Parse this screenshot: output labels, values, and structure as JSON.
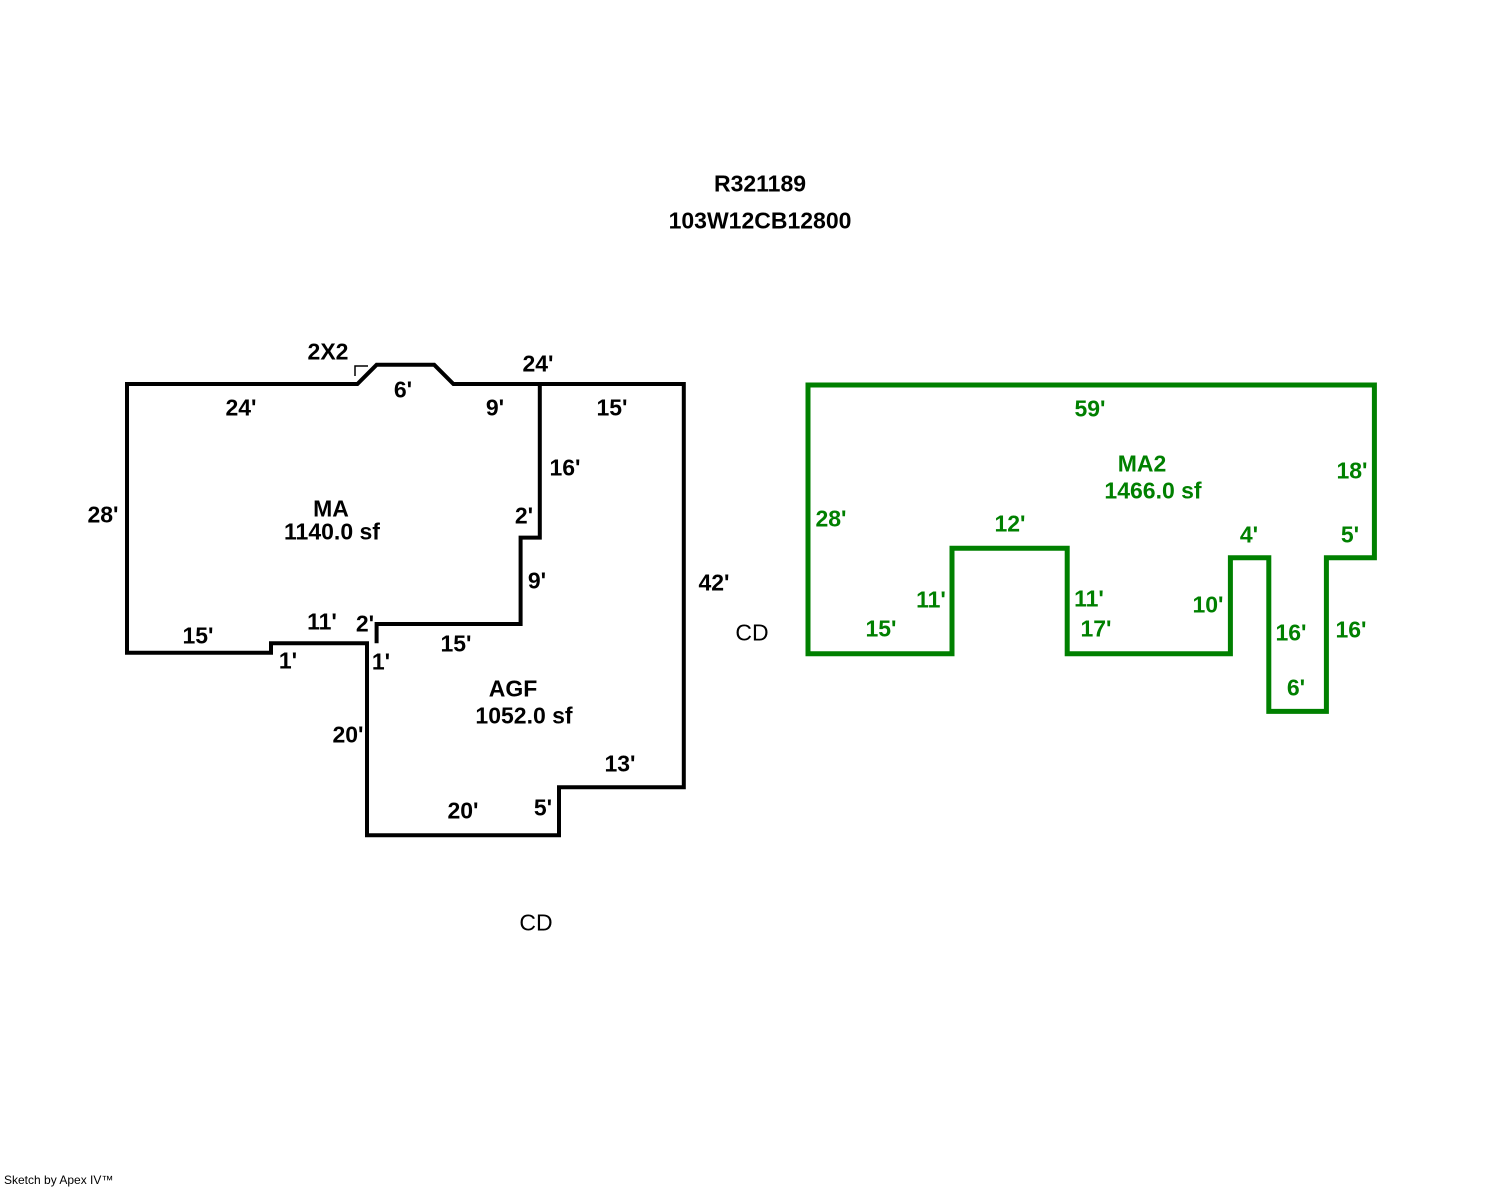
{
  "header": {
    "line1": "R321189",
    "line2": "103W12CB12800"
  },
  "footer": {
    "credit": "Sketch by Apex IV™"
  },
  "colors": {
    "black": "#000000",
    "green": "#008000",
    "background": "#ffffff"
  },
  "sketch": {
    "scale_px_per_ft": 9.6,
    "figures": [
      {
        "name": "main-building",
        "color": "black",
        "stroke_width": 4,
        "origin_px": [
          127,
          384
        ],
        "paths": [
          {
            "name": "outer-perimeter",
            "closed": true,
            "points_ft": [
              [
                0,
                0
              ],
              [
                24,
                0
              ],
              [
                26,
                -2
              ],
              [
                32,
                -2
              ],
              [
                34,
                0
              ],
              [
                58,
                0
              ],
              [
                58,
                42
              ],
              [
                45,
                42
              ],
              [
                45,
                47
              ],
              [
                25,
                47
              ],
              [
                25,
                27
              ],
              [
                15,
                27
              ],
              [
                15,
                28
              ],
              [
                0,
                28
              ]
            ]
          },
          {
            "name": "ma-agf-divider",
            "closed": false,
            "points_ft": [
              [
                43,
                0
              ],
              [
                43,
                16
              ],
              [
                41,
                16
              ],
              [
                41,
                25
              ],
              [
                26,
                25
              ],
              [
                26,
                27
              ]
            ]
          }
        ],
        "corner_marks": [
          {
            "name": "bay-corner-mark",
            "points_px": [
              [
                355,
                376
              ],
              [
                355,
                366
              ],
              [
                368,
                366
              ]
            ]
          }
        ],
        "area_labels": [
          {
            "text": "MA",
            "x": 331,
            "y": 509
          },
          {
            "text": "1140.0 sf",
            "x": 332,
            "y": 532
          },
          {
            "text": "AGF",
            "x": 513,
            "y": 689
          },
          {
            "text": "1052.0 sf",
            "x": 524,
            "y": 716
          }
        ],
        "dim_labels": [
          {
            "text": "2X2",
            "x": 328,
            "y": 352
          },
          {
            "text": "24'",
            "x": 241,
            "y": 408
          },
          {
            "text": "6'",
            "x": 403,
            "y": 390
          },
          {
            "text": "9'",
            "x": 495,
            "y": 408
          },
          {
            "text": "24'",
            "x": 538,
            "y": 364
          },
          {
            "text": "15'",
            "x": 612,
            "y": 408
          },
          {
            "text": "16'",
            "x": 565,
            "y": 468
          },
          {
            "text": "28'",
            "x": 103,
            "y": 515
          },
          {
            "text": "2'",
            "x": 524,
            "y": 516
          },
          {
            "text": "9'",
            "x": 537,
            "y": 581
          },
          {
            "text": "42'",
            "x": 714,
            "y": 583
          },
          {
            "text": "15'",
            "x": 198,
            "y": 636
          },
          {
            "text": "11'",
            "x": 322,
            "y": 622
          },
          {
            "text": "2'",
            "x": 365,
            "y": 624
          },
          {
            "text": "1'",
            "x": 288,
            "y": 661
          },
          {
            "text": "1'",
            "x": 381,
            "y": 662
          },
          {
            "text": "15'",
            "x": 456,
            "y": 644
          },
          {
            "text": "20'",
            "x": 348,
            "y": 735
          },
          {
            "text": "13'",
            "x": 620,
            "y": 764
          },
          {
            "text": "20'",
            "x": 463,
            "y": 811
          },
          {
            "text": "5'",
            "x": 543,
            "y": 808
          }
        ],
        "adjacent_labels": [
          {
            "text": "CD",
            "x": 752,
            "y": 633
          },
          {
            "text": "CD",
            "x": 536,
            "y": 923
          }
        ]
      },
      {
        "name": "ma2-building",
        "color": "green",
        "stroke_width": 5,
        "origin_px": [
          808,
          385
        ],
        "paths": [
          {
            "name": "ma2-perimeter",
            "closed": true,
            "points_ft": [
              [
                0,
                0
              ],
              [
                59,
                0
              ],
              [
                59,
                18
              ],
              [
                54,
                18
              ],
              [
                54,
                34
              ],
              [
                48,
                34
              ],
              [
                48,
                18
              ],
              [
                44,
                18
              ],
              [
                44,
                28
              ],
              [
                27,
                28
              ],
              [
                27,
                17
              ],
              [
                15,
                17
              ],
              [
                15,
                28
              ],
              [
                0,
                28
              ]
            ]
          }
        ],
        "corner_marks": [],
        "area_labels": [
          {
            "text": "MA2",
            "x": 1142,
            "y": 464
          },
          {
            "text": "1466.0 sf",
            "x": 1153,
            "y": 491
          }
        ],
        "dim_labels": [
          {
            "text": "59'",
            "x": 1090,
            "y": 409
          },
          {
            "text": "28'",
            "x": 831,
            "y": 519
          },
          {
            "text": "18'",
            "x": 1352,
            "y": 471
          },
          {
            "text": "12'",
            "x": 1010,
            "y": 524
          },
          {
            "text": "4'",
            "x": 1249,
            "y": 535
          },
          {
            "text": "5'",
            "x": 1350,
            "y": 535
          },
          {
            "text": "11'",
            "x": 931,
            "y": 600
          },
          {
            "text": "11'",
            "x": 1089,
            "y": 599
          },
          {
            "text": "10'",
            "x": 1208,
            "y": 605
          },
          {
            "text": "15'",
            "x": 881,
            "y": 629
          },
          {
            "text": "17'",
            "x": 1096,
            "y": 629
          },
          {
            "text": "16'",
            "x": 1291,
            "y": 633
          },
          {
            "text": "16'",
            "x": 1351,
            "y": 630
          },
          {
            "text": "6'",
            "x": 1296,
            "y": 688
          }
        ],
        "adjacent_labels": []
      }
    ]
  }
}
